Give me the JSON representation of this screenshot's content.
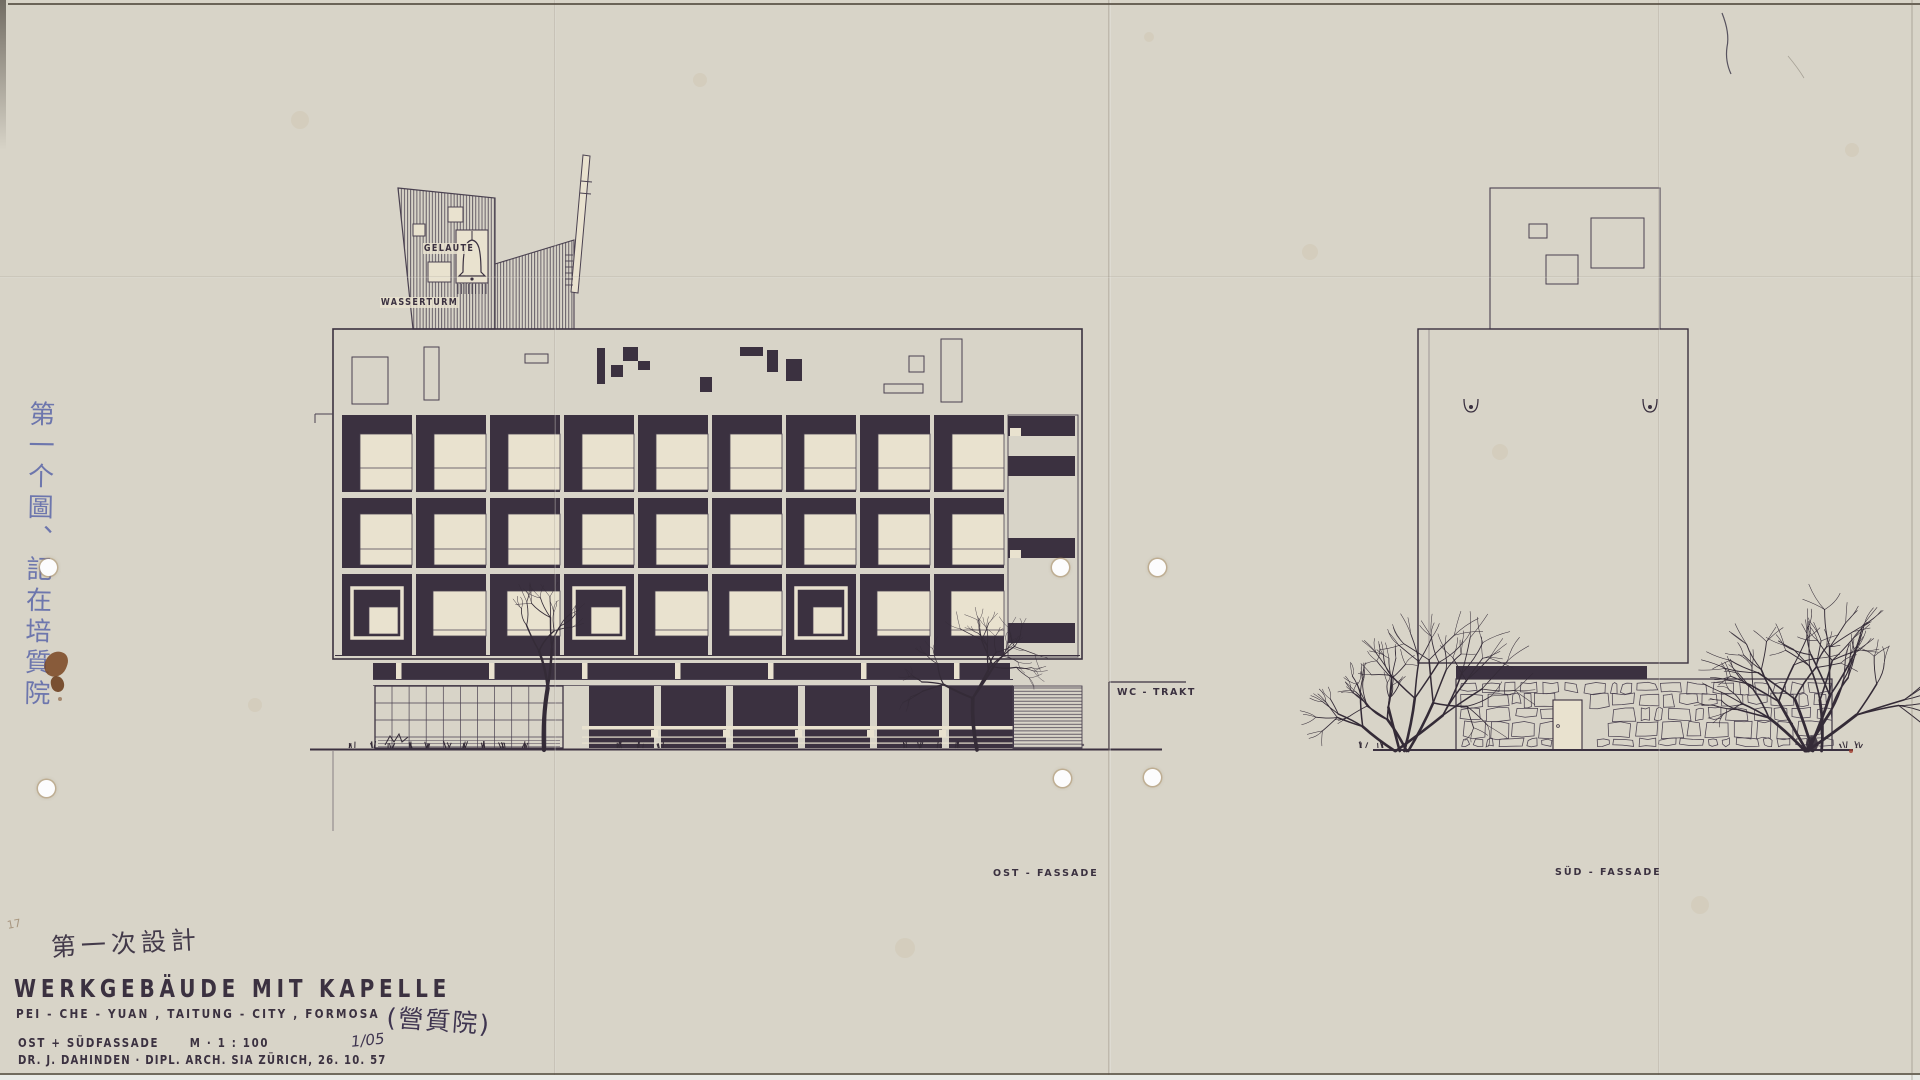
{
  "sheet": {
    "labels": {
      "gelaeute": "GELÄUTE",
      "wasserturm": "WASSERTURM",
      "wc_trakt": "WC - TRAKT",
      "ost_fassade": "OST - FASSADE",
      "sued_fassade": "SÜD - FASSADE"
    },
    "title_block": {
      "pre_title_note": "第一次設計",
      "title": "WERKGEBÄUDE MIT KAPELLE",
      "subtitle": "PEI - CHE - YUAN , TAITUNG - CITY , FORMOSA",
      "subtitle_note": "(營質院)",
      "facade_line": "OST + SÜDFASSADE",
      "scale": "M · 1 : 100",
      "sheet_no": "1/05",
      "author_line": "DR. J. DAHINDEN  ·  DIPL. ARCH. SIA ZÜRICH, 26. 10. 57"
    },
    "margin_notes": {
      "left_vertical": "第一个圖、記在培質院",
      "sheet_number": "17"
    },
    "colors": {
      "paper": "#e9e2cf",
      "ink": "#3b3140",
      "line": "#4a4150",
      "blue_ink": "#6d76ad",
      "stain": "#7c4a26"
    },
    "drawing_spec": {
      "east_facade": {
        "floors": 3,
        "bays": 9,
        "ring_bays": [
          0,
          3,
          6
        ]
      },
      "south_facade": {
        "rooftop_squares": 3,
        "wall_type": "rubble-stone",
        "has_door": true
      }
    }
  }
}
